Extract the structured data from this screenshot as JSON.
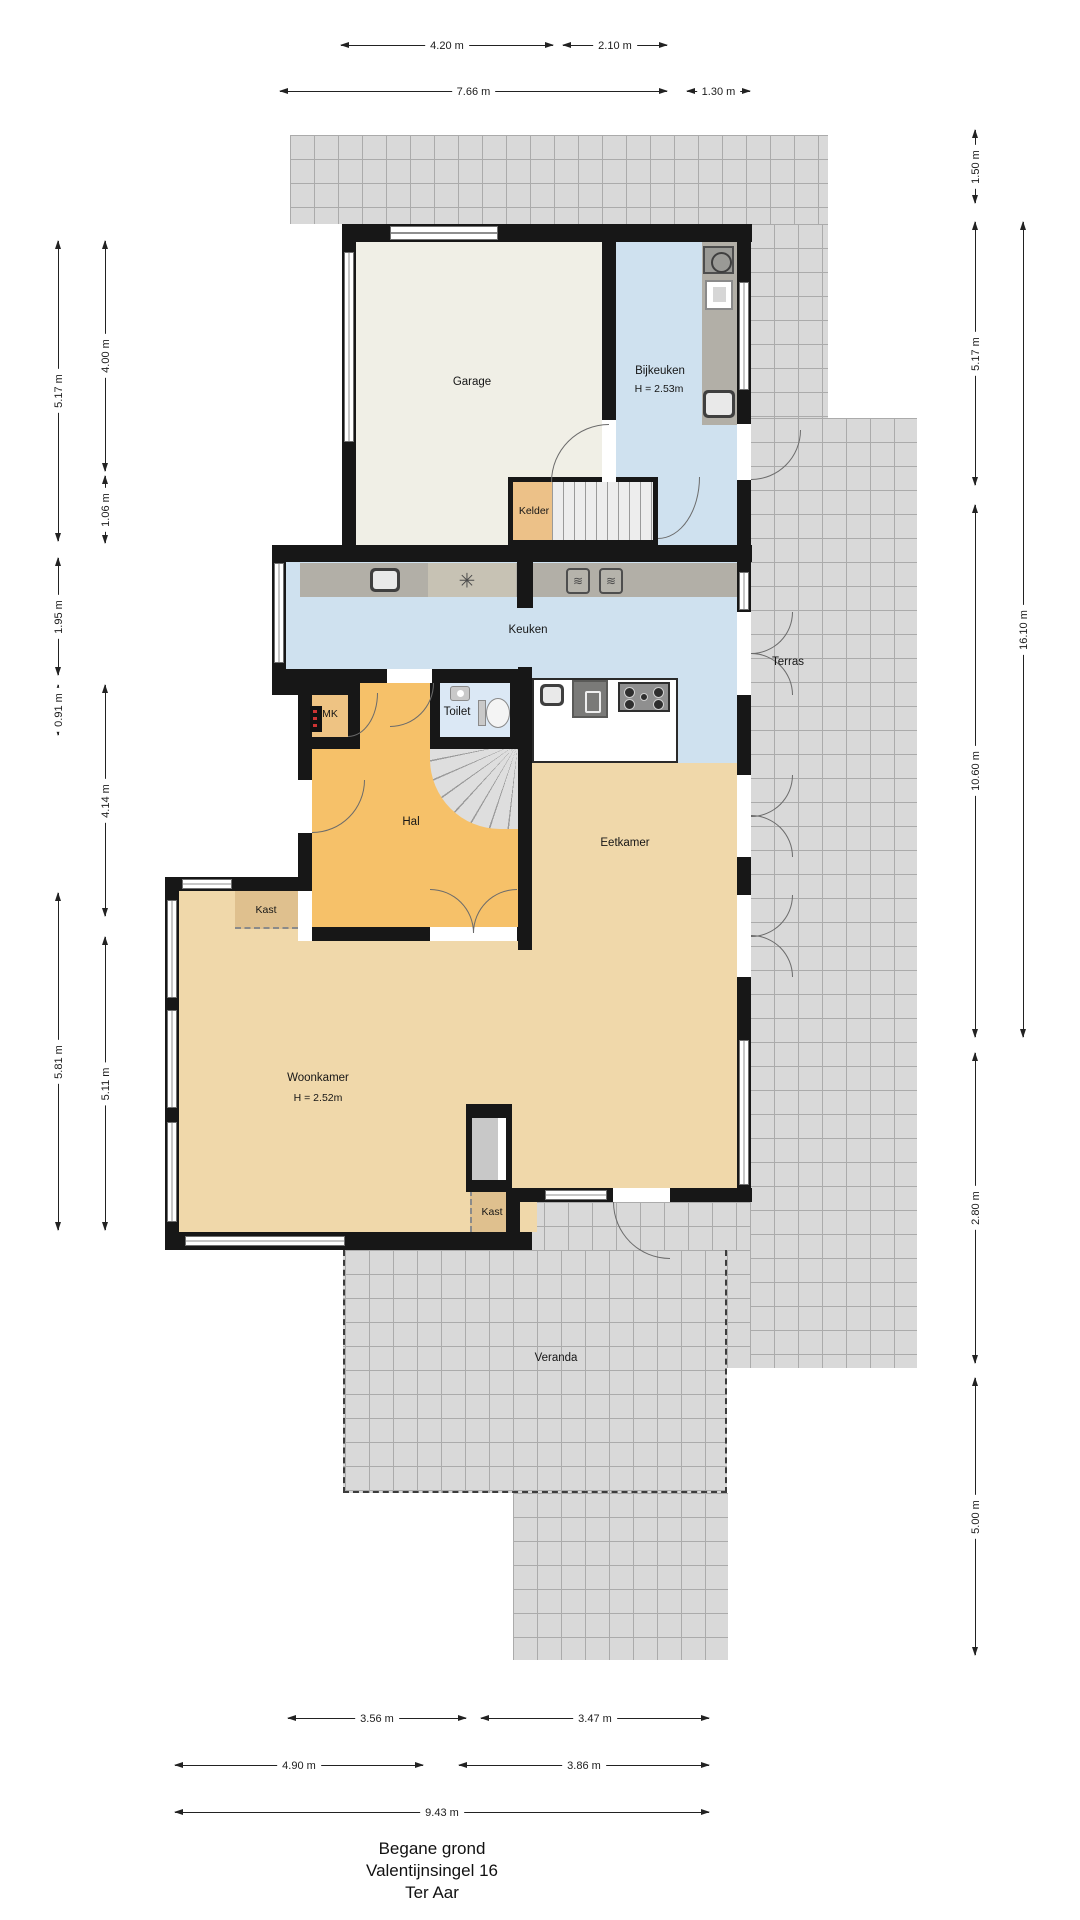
{
  "title": {
    "line1": "Begane grond",
    "line2": "Valentijnsingel 16",
    "line3": "Ter Aar"
  },
  "rooms": {
    "garage": {
      "label": "Garage"
    },
    "bijkeuken": {
      "label": "Bijkeuken",
      "height": "H = 2.53m"
    },
    "kelder": {
      "label": "Kelder"
    },
    "keuken": {
      "label": "Keuken"
    },
    "mk": {
      "label": "MK"
    },
    "toilet": {
      "label": "Toilet"
    },
    "hal": {
      "label": "Hal"
    },
    "eetkamer": {
      "label": "Eetkamer"
    },
    "terras": {
      "label": "Terras"
    },
    "kast_hal": {
      "label": "Kast"
    },
    "woonkamer": {
      "label": "Woonkamer",
      "height": "H = 2.52m"
    },
    "kast_woonkamer": {
      "label": "Kast"
    },
    "veranda": {
      "label": "Veranda"
    }
  },
  "dims": {
    "top": [
      "4.20 m",
      "2.10 m",
      "7.66 m",
      "1.30 m"
    ],
    "left_outer": [
      "5.17 m",
      "1.95 m",
      "0.91 m",
      "5.81 m"
    ],
    "left_inner": [
      "4.00 m",
      "1.06 m",
      "4.14 m",
      "5.11 m"
    ],
    "right_inner": [
      "1.50 m",
      "5.17 m",
      "10.60 m",
      "2.80 m",
      "5.00 m"
    ],
    "right_outer": [
      "16.10 m"
    ],
    "bottom": [
      "3.56 m",
      "3.47 m",
      "4.90 m",
      "3.86 m",
      "9.43 m"
    ]
  },
  "icons": {
    "extractor": "✳",
    "oven": "≋"
  },
  "colors": {
    "wall": "#171717",
    "tile": "#d9d9d9",
    "garage": "#f0efe6",
    "keuken_blue": "#cfe1ef",
    "toilet_blue": "#dbe8f5",
    "hal_orange": "#f6c169",
    "mk_orange": "#eec383",
    "kelder_orange": "#ecc188",
    "woon_tan": "#f0d8aa",
    "kast_tan": "#dfc08e",
    "counter_gray": "#b2afa7"
  }
}
